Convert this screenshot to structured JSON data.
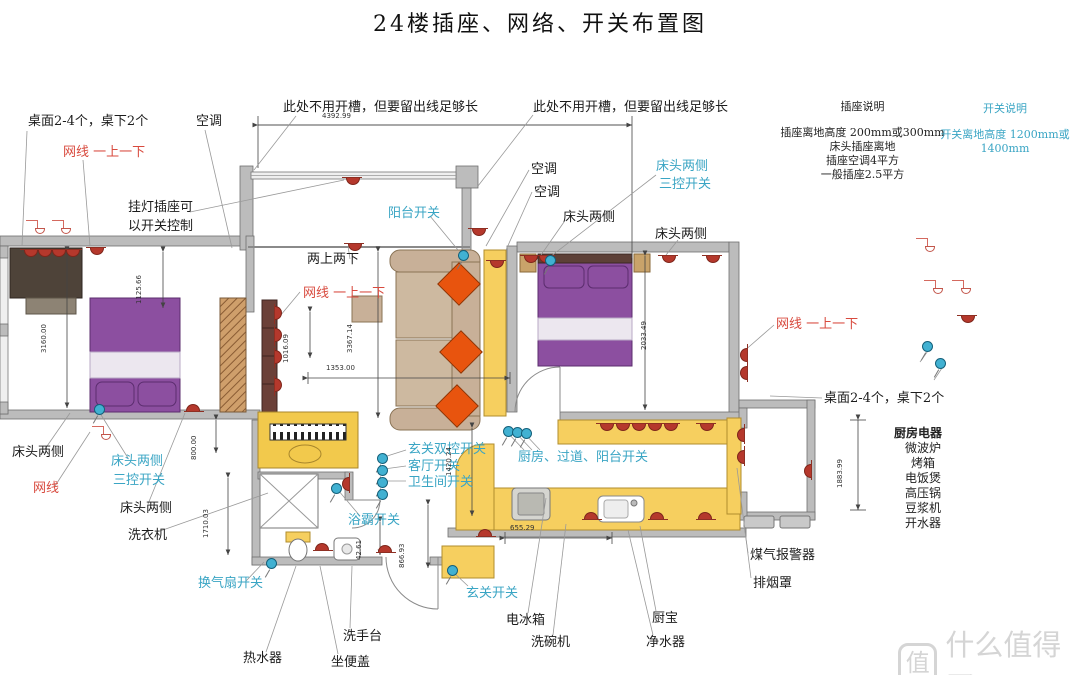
{
  "title": "24楼插座、网络、开关布置图",
  "legend": {
    "socket_title": "插座说明",
    "socket_lines": [
      "插座离地高度  200mm或300mm",
      "床头插座离地",
      "插座空调4平方",
      "一般插座2.5平方"
    ],
    "switch_title": "开关说明",
    "switch_line": "开关离地高度  1200mm或1400mm"
  },
  "kitchen": {
    "title": "厨房电器",
    "items": [
      "微波炉",
      "烤箱",
      "电饭煲",
      "高压锅",
      "豆浆机",
      "开水器"
    ]
  },
  "watermark": {
    "badge": "值",
    "text": "什么值得买"
  },
  "colors": {
    "socket_red": "#b5382c",
    "switch_cyan": "#41b1d2",
    "label_red": "#d84a3e",
    "label_cyan": "#3aa5c4",
    "wall_gray": "#bcbcbc",
    "bed_purple": "#8c4fa0",
    "counter_yellow": "#f6cf5f",
    "sofa_tan": "#c8b098",
    "cushion_orange": "#e8540e"
  },
  "labels": [
    {
      "id": "desk-sockets-left",
      "text": "桌面2-4个，桌下2个",
      "x": 28,
      "y": 115,
      "cls": ""
    },
    {
      "id": "netcable-left",
      "text": "网线 一上一下",
      "x": 63,
      "y": 146,
      "cls": "red"
    },
    {
      "id": "ac-left",
      "text": "空调",
      "x": 196,
      "y": 115,
      "cls": ""
    },
    {
      "id": "lamp-socket-1",
      "text": "挂灯插座可",
      "x": 128,
      "y": 201,
      "cls": ""
    },
    {
      "id": "lamp-socket-2",
      "text": "以开关控制",
      "x": 128,
      "y": 220,
      "cls": ""
    },
    {
      "id": "no-groove-1",
      "text": "此处不用开槽，但要留出线足够长",
      "x": 283,
      "y": 101,
      "cls": ""
    },
    {
      "id": "no-groove-2",
      "text": "此处不用开槽，但要留出线足够长",
      "x": 533,
      "y": 101,
      "cls": ""
    },
    {
      "id": "ac-mid-1",
      "text": "空调",
      "x": 531,
      "y": 163,
      "cls": ""
    },
    {
      "id": "ac-mid-2",
      "text": "空调",
      "x": 534,
      "y": 186,
      "cls": ""
    },
    {
      "id": "bedside-3way-right-1",
      "text": "床头两侧",
      "x": 656,
      "y": 160,
      "cls": "cyan"
    },
    {
      "id": "bedside-3way-right-2",
      "text": "三控开关",
      "x": 659,
      "y": 178,
      "cls": "cyan"
    },
    {
      "id": "bedside-right-a",
      "text": "床头两侧",
      "x": 563,
      "y": 211,
      "cls": ""
    },
    {
      "id": "bedside-right-b",
      "text": "床头两侧",
      "x": 655,
      "y": 228,
      "cls": ""
    },
    {
      "id": "balcony-switch",
      "text": "阳台开关",
      "x": 388,
      "y": 207,
      "cls": "cyan"
    },
    {
      "id": "two-up-two-down",
      "text": "两上两下",
      "x": 307,
      "y": 253,
      "cls": ""
    },
    {
      "id": "netcable-mid",
      "text": "网线 一上一下",
      "x": 303,
      "y": 287,
      "cls": "red"
    },
    {
      "id": "netcable-right",
      "text": "网线 一上一下",
      "x": 776,
      "y": 318,
      "cls": "red"
    },
    {
      "id": "desk-sockets-right",
      "text": "桌面2-4个，桌下2个",
      "x": 824,
      "y": 392,
      "cls": ""
    },
    {
      "id": "bedside-bl",
      "text": "床头两侧",
      "x": 12,
      "y": 446,
      "cls": ""
    },
    {
      "id": "netcable-bl",
      "text": "网线",
      "x": 33,
      "y": 482,
      "cls": "red"
    },
    {
      "id": "bedside-3way-left-1",
      "text": "床头两侧",
      "x": 111,
      "y": 455,
      "cls": "cyan"
    },
    {
      "id": "bedside-3way-left-2",
      "text": "三控开关",
      "x": 113,
      "y": 474,
      "cls": "cyan"
    },
    {
      "id": "bedside-bl2",
      "text": "床头两侧",
      "x": 120,
      "y": 502,
      "cls": ""
    },
    {
      "id": "washing-machine",
      "text": "洗衣机",
      "x": 128,
      "y": 529,
      "cls": ""
    },
    {
      "id": "entry-double-switch",
      "text": "玄关双控开关",
      "x": 408,
      "y": 443,
      "cls": "cyan"
    },
    {
      "id": "livingroom-switch",
      "text": "客厅开关",
      "x": 408,
      "y": 460,
      "cls": "cyan"
    },
    {
      "id": "bathroom-switch",
      "text": "卫生间开关",
      "x": 408,
      "y": 476,
      "cls": "cyan"
    },
    {
      "id": "bath-heater-switch",
      "text": "浴霸开关",
      "x": 348,
      "y": 514,
      "cls": "cyan"
    },
    {
      "id": "kitchen-corridor-balcony-switch",
      "text": "厨房、过道、阳台开关",
      "x": 518,
      "y": 451,
      "cls": "cyan"
    },
    {
      "id": "fan-switch",
      "text": "换气扇开关",
      "x": 198,
      "y": 577,
      "cls": "cyan"
    },
    {
      "id": "water-heater",
      "text": "热水器",
      "x": 243,
      "y": 652,
      "cls": ""
    },
    {
      "id": "toilet-lid",
      "text": "坐便盖",
      "x": 331,
      "y": 656,
      "cls": ""
    },
    {
      "id": "wash-basin",
      "text": "洗手台",
      "x": 343,
      "y": 630,
      "cls": ""
    },
    {
      "id": "entry-switch",
      "text": "玄关开关",
      "x": 466,
      "y": 587,
      "cls": "cyan"
    },
    {
      "id": "fridge",
      "text": "电冰箱",
      "x": 506,
      "y": 614,
      "cls": ""
    },
    {
      "id": "dishwasher",
      "text": "洗碗机",
      "x": 531,
      "y": 636,
      "cls": ""
    },
    {
      "id": "kitchen-water-heater",
      "text": "厨宝",
      "x": 652,
      "y": 612,
      "cls": ""
    },
    {
      "id": "water-purifier",
      "text": "净水器",
      "x": 646,
      "y": 636,
      "cls": ""
    },
    {
      "id": "gas-alarm",
      "text": "煤气报警器",
      "x": 750,
      "y": 549,
      "cls": ""
    },
    {
      "id": "range-hood",
      "text": "排烟罩",
      "x": 753,
      "y": 577,
      "cls": ""
    }
  ],
  "dimensions": [
    {
      "text": "4392.99",
      "x": 322,
      "y": 112,
      "v": false
    },
    {
      "text": "1125.66",
      "x": 143,
      "y": 296,
      "v": true
    },
    {
      "text": "3160.00",
      "x": 48,
      "y": 345,
      "v": true
    },
    {
      "text": "1016.09",
      "x": 290,
      "y": 355,
      "v": true
    },
    {
      "text": "1353.00",
      "x": 326,
      "y": 364,
      "v": false
    },
    {
      "text": "3367.14",
      "x": 354,
      "y": 345,
      "v": true
    },
    {
      "text": "800.00",
      "x": 198,
      "y": 452,
      "v": true
    },
    {
      "text": "1710.03",
      "x": 210,
      "y": 530,
      "v": true
    },
    {
      "text": "1420.24",
      "x": 453,
      "y": 468,
      "v": true
    },
    {
      "text": "42.61",
      "x": 363,
      "y": 552,
      "v": true
    },
    {
      "text": "866.93",
      "x": 406,
      "y": 560,
      "v": true
    },
    {
      "text": "655.29",
      "x": 510,
      "y": 524,
      "v": false
    },
    {
      "text": "2033.49",
      "x": 648,
      "y": 342,
      "v": true
    },
    {
      "text": "1883.99",
      "x": 844,
      "y": 480,
      "v": true
    }
  ],
  "electrical_points": {
    "sockets": [
      [
        22,
        249,
        0
      ],
      [
        36,
        249,
        0
      ],
      [
        50,
        249,
        0
      ],
      [
        64,
        249,
        0
      ],
      [
        88,
        247,
        0
      ],
      [
        344,
        177,
        0
      ],
      [
        346,
        243,
        0
      ],
      [
        470,
        228,
        0
      ],
      [
        488,
        260,
        0
      ],
      [
        186,
        404,
        180
      ],
      [
        315,
        543,
        180
      ],
      [
        378,
        545,
        180
      ],
      [
        270,
        310,
        270
      ],
      [
        270,
        332,
        270
      ],
      [
        270,
        354,
        270
      ],
      [
        270,
        382,
        270
      ],
      [
        522,
        255,
        0
      ],
      [
        537,
        255,
        0
      ],
      [
        660,
        255,
        0
      ],
      [
        704,
        255,
        0
      ],
      [
        598,
        423,
        0
      ],
      [
        614,
        423,
        0
      ],
      [
        630,
        423,
        0
      ],
      [
        646,
        423,
        0
      ],
      [
        662,
        423,
        0
      ],
      [
        698,
        423,
        0
      ],
      [
        733,
        430,
        90
      ],
      [
        733,
        452,
        90
      ],
      [
        736,
        350,
        90
      ],
      [
        736,
        368,
        90
      ],
      [
        338,
        479,
        90
      ],
      [
        478,
        529,
        180
      ],
      [
        584,
        512,
        180
      ],
      [
        650,
        512,
        180
      ],
      [
        698,
        512,
        180
      ],
      [
        959,
        315,
        0
      ],
      [
        800,
        466,
        90
      ]
    ],
    "switches": [
      [
        94,
        404
      ],
      [
        458,
        250
      ],
      [
        545,
        255
      ],
      [
        331,
        483
      ],
      [
        377,
        453
      ],
      [
        377,
        465
      ],
      [
        377,
        477
      ],
      [
        377,
        489
      ],
      [
        503,
        426
      ],
      [
        512,
        427
      ],
      [
        521,
        428
      ],
      [
        447,
        565
      ],
      [
        266,
        558
      ],
      [
        922,
        341
      ],
      [
        935,
        358
      ]
    ],
    "socket_glyphs": [
      [
        26,
        218
      ],
      [
        52,
        218
      ],
      [
        92,
        424
      ],
      [
        916,
        236
      ],
      [
        924,
        278
      ],
      [
        952,
        278
      ]
    ]
  }
}
